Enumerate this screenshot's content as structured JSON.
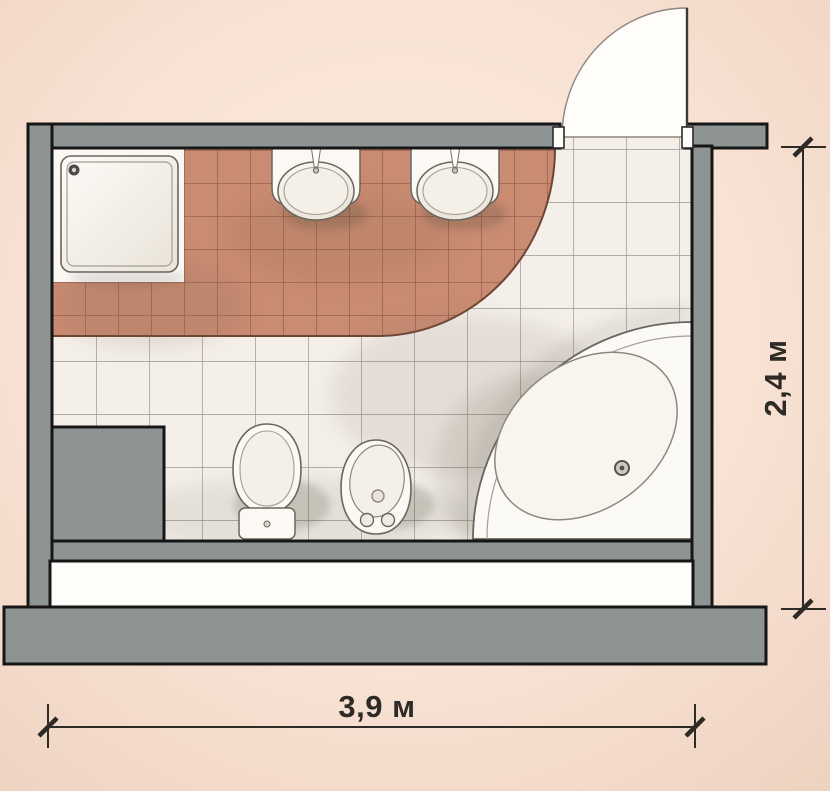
{
  "diagram": {
    "type": "bathroom-floor-plan-top-view",
    "dimensions": {
      "width_label": "3,9 м",
      "height_label": "2,4 м"
    },
    "fixtures": [
      "shower-tray",
      "washbasin-left",
      "washbasin-right",
      "toilet",
      "bidet",
      "corner-bathtub",
      "door-swing"
    ],
    "colors": {
      "background": "#f8e2d4",
      "wall": "#8d9493",
      "outline": "#161616",
      "accent_tile": "#c98b71",
      "accent_tile_grout": "#8a5340",
      "floor_tile": "#f4efe9",
      "floor_tile_grout": "#7d7871",
      "fixture_fill": "#fcf9f5",
      "dimension_color": "#2e2a26"
    }
  }
}
